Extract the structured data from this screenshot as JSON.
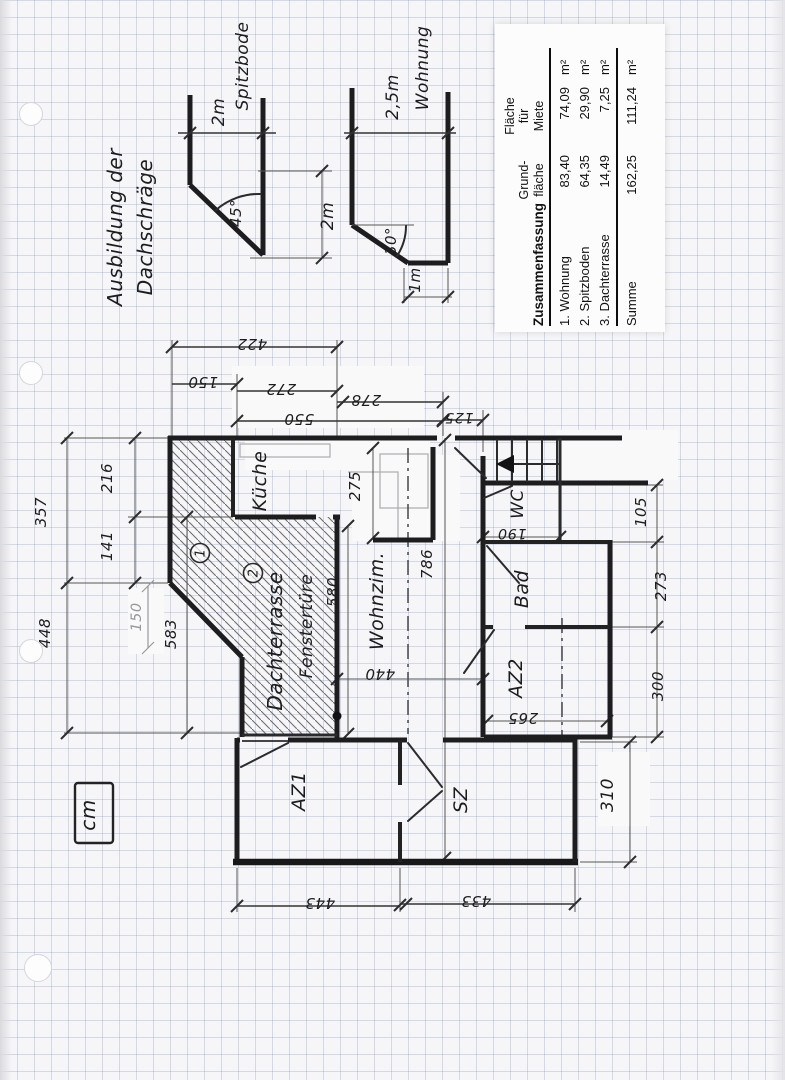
{
  "colors": {
    "ink": "#1d1d1f",
    "pencil": "#9a9a9e",
    "grid_line": "#8094b9",
    "paper": "#f6f6f8"
  },
  "annotations": {
    "title_line1": "Ausbildung der",
    "title_line2": "Dachschräge"
  },
  "roof_sections": {
    "left": {
      "width_label_line1": "2m",
      "width_label_line2": "Spitzbode",
      "angle": "45°",
      "height_label": "2m"
    },
    "right": {
      "width_label_line1": "2,5m",
      "width_label_line2": "Wohnung",
      "angle": "30°",
      "bottom_label": "1m"
    }
  },
  "summary_table": {
    "title": "Zusammenfassung",
    "col1_header": [
      "Grund-",
      "fläche"
    ],
    "col2_header": [
      "Fläche",
      "für",
      "Miete"
    ],
    "rows": [
      {
        "label": "1. Wohnung",
        "grund": "83,40",
        "miete": "74,09",
        "unit": "m²"
      },
      {
        "label": "2. Spitzboden",
        "grund": "64,35",
        "miete": "29,90",
        "unit": "m²"
      },
      {
        "label": "3. Dachterrasse",
        "grund": "14,49",
        "miete": "7,25",
        "unit": "m²"
      },
      {
        "label": "Summe",
        "grund": "162,25",
        "miete": "111,24",
        "unit": "m²"
      }
    ]
  },
  "floor_plan": {
    "rooms": {
      "kueche": "Küche",
      "wohnzimmer": "Wohnzim.",
      "wc": "WC",
      "bad": "Bad",
      "az2": "AZ2",
      "az1": "AZ1",
      "sz": "SZ",
      "dachterrasse": "Dachterrasse",
      "fenstertuere": "Fenstertüre"
    },
    "markers": {
      "m1": "1",
      "m2": "2"
    },
    "dims": {
      "d422": "422",
      "d150_top": "150",
      "d272": "272",
      "d278": "278",
      "d550": "550",
      "d125": "125",
      "d357": "357",
      "d216": "216",
      "d141": "141",
      "d448": "448",
      "d583": "583",
      "d150_pencil": "150",
      "d275": "275",
      "d580": "580",
      "d786": "786",
      "d440": "440",
      "d190": "190",
      "d265": "265",
      "d105": "105",
      "d273": "273",
      "d300": "300",
      "d310": "310",
      "d443": "443",
      "d433": "433"
    }
  },
  "unit_box": {
    "label": "cm"
  }
}
